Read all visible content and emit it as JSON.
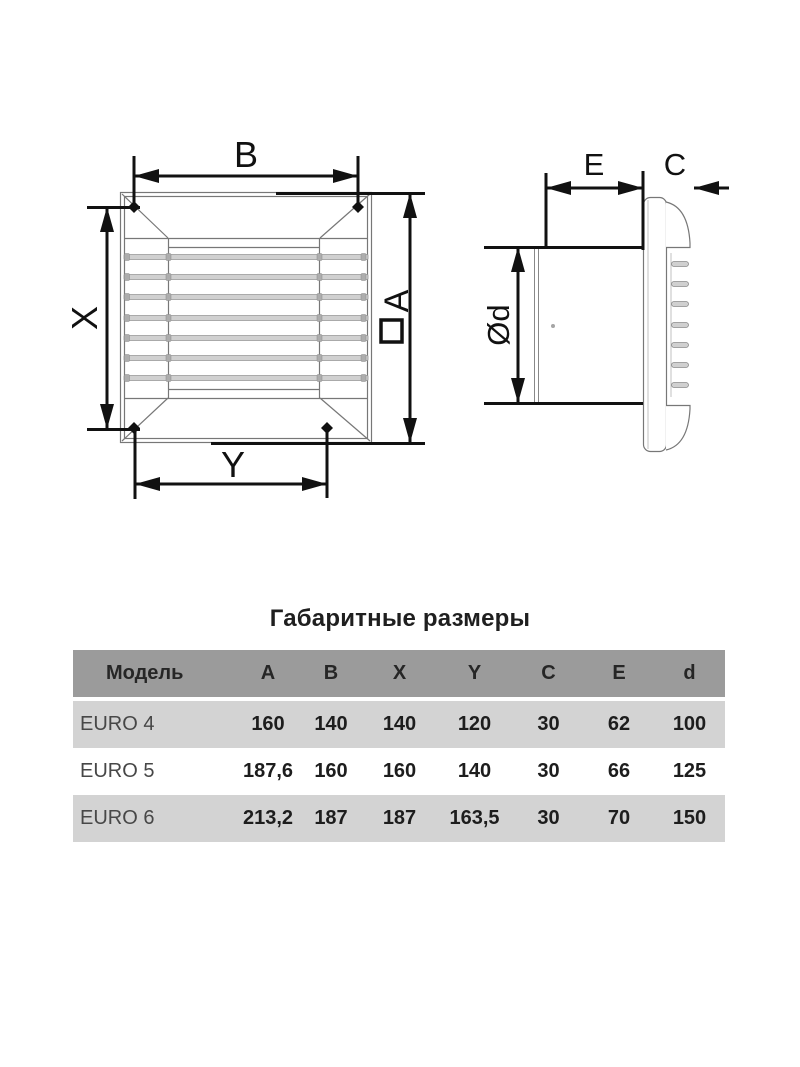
{
  "diagram": {
    "front_view": {
      "labels": {
        "width_top": "B",
        "height_left": "X",
        "width_bottom": "Y",
        "height_right": "A"
      },
      "height_right_symbol": "square-section"
    },
    "side_view": {
      "labels": {
        "depth_body": "E",
        "depth_grille": "C",
        "diameter": "Ød"
      }
    }
  },
  "table": {
    "title": "Габаритные размеры",
    "columns": [
      "Модель",
      "A",
      "B",
      "X",
      "Y",
      "C",
      "E",
      "d"
    ],
    "rows": [
      {
        "model": "EURO 4",
        "values": [
          "160",
          "140",
          "140",
          "120",
          "30",
          "62",
          "100"
        ]
      },
      {
        "model": "EURO 5",
        "values": [
          "187,6",
          "160",
          "160",
          "140",
          "30",
          "66",
          "125"
        ]
      },
      {
        "model": "EURO 6",
        "values": [
          "213,2",
          "187",
          "187",
          "163,5",
          "30",
          "70",
          "150"
        ]
      }
    ]
  },
  "colors": {
    "dimension_line": "#111111",
    "structure_line": "#777777",
    "slat_fill": "#d0d0d0",
    "table_header_bg": "#9b9b9b",
    "table_row_alt_bg": "#d3d3d3",
    "table_row_bg": "#ffffff",
    "text": "#1f1f1f"
  }
}
